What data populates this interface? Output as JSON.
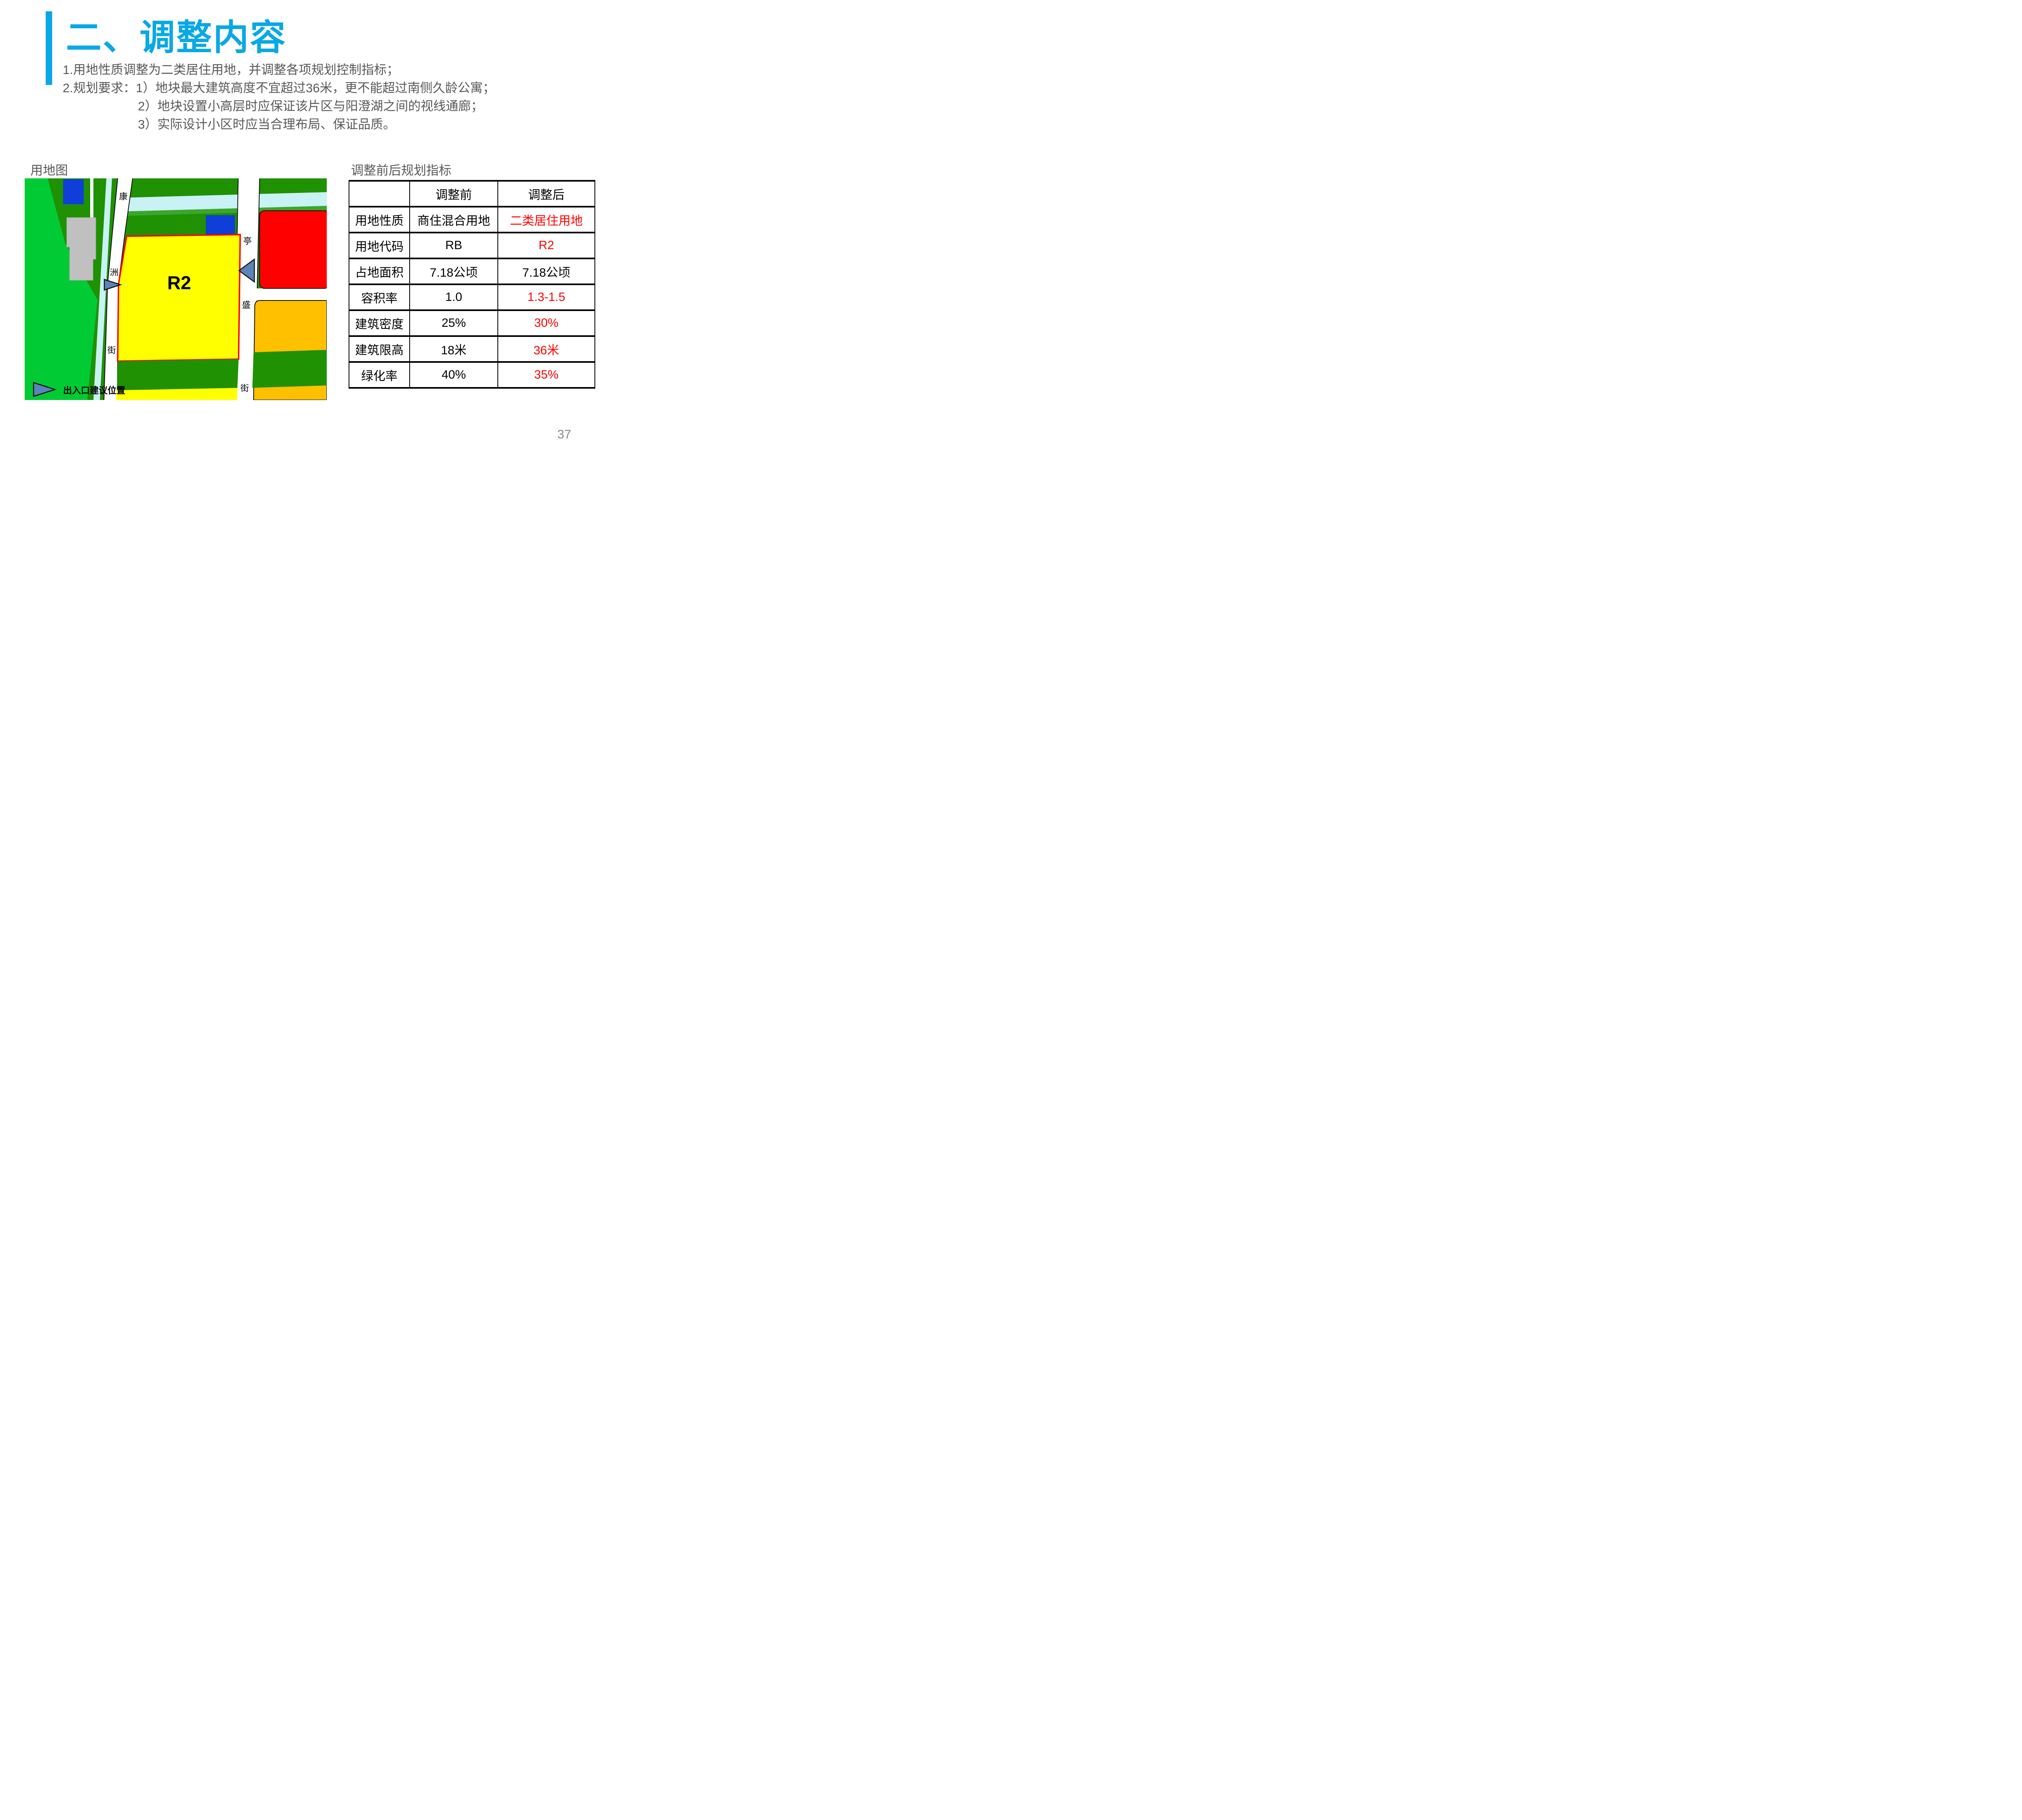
{
  "slide": {
    "title": "二、调整内容",
    "body_lines": [
      "1.用地性质调整为二类居住用地，并调整各项规划控制指标；",
      "2.规划要求：1）地块最大建筑高度不宜超过36米，更不能超过南侧久龄公寓；",
      "2）地块设置小高层时应保证该片区与阳澄湖之间的视线通廊；",
      "3）实际设计小区时应当合理布局、保证品质。"
    ],
    "page_number": "37",
    "accent_color": "#0aa8e6",
    "body_color": "#595959"
  },
  "map": {
    "label": "用地图",
    "parcel_code": "R2",
    "streets": {
      "left": [
        "康",
        "洲",
        "街"
      ],
      "right": [
        "亭",
        "盛",
        "街"
      ]
    },
    "legend": "出入口建议位置",
    "colors": {
      "residential_parcel": "#ffff00",
      "parcel_boundary": "#ff0000",
      "commercial_parcel": "#ff0000",
      "mixed_parcel": "#ffc000",
      "water": "#c9f2f4",
      "green_bright": "#00cb35",
      "green_dark": "#1f9102",
      "building": "#c0c0c0",
      "blue_parcel": "#0f3fd8",
      "entrance_arrow": "#5b84b8"
    }
  },
  "table": {
    "label": "调整前后规划指标",
    "headers": [
      "",
      "调整前",
      "调整后"
    ],
    "changed_color": "#ff0000",
    "rows": [
      {
        "name": "用地性质",
        "before": "商住混合用地",
        "after": "二类居住用地",
        "changed": true
      },
      {
        "name": "用地代码",
        "before": "RB",
        "after": "R2",
        "changed": true
      },
      {
        "name": "占地面积",
        "before": "7.18公顷",
        "after": "7.18公顷",
        "changed": false
      },
      {
        "name": "容积率",
        "before": "1.0",
        "after": "1.3-1.5",
        "changed": true
      },
      {
        "name": "建筑密度",
        "before": "25%",
        "after": "30%",
        "changed": true
      },
      {
        "name": "建筑限高",
        "before": "18米",
        "after": "36米",
        "changed": true
      },
      {
        "name": "绿化率",
        "before": "40%",
        "after": "35%",
        "changed": true
      }
    ]
  }
}
